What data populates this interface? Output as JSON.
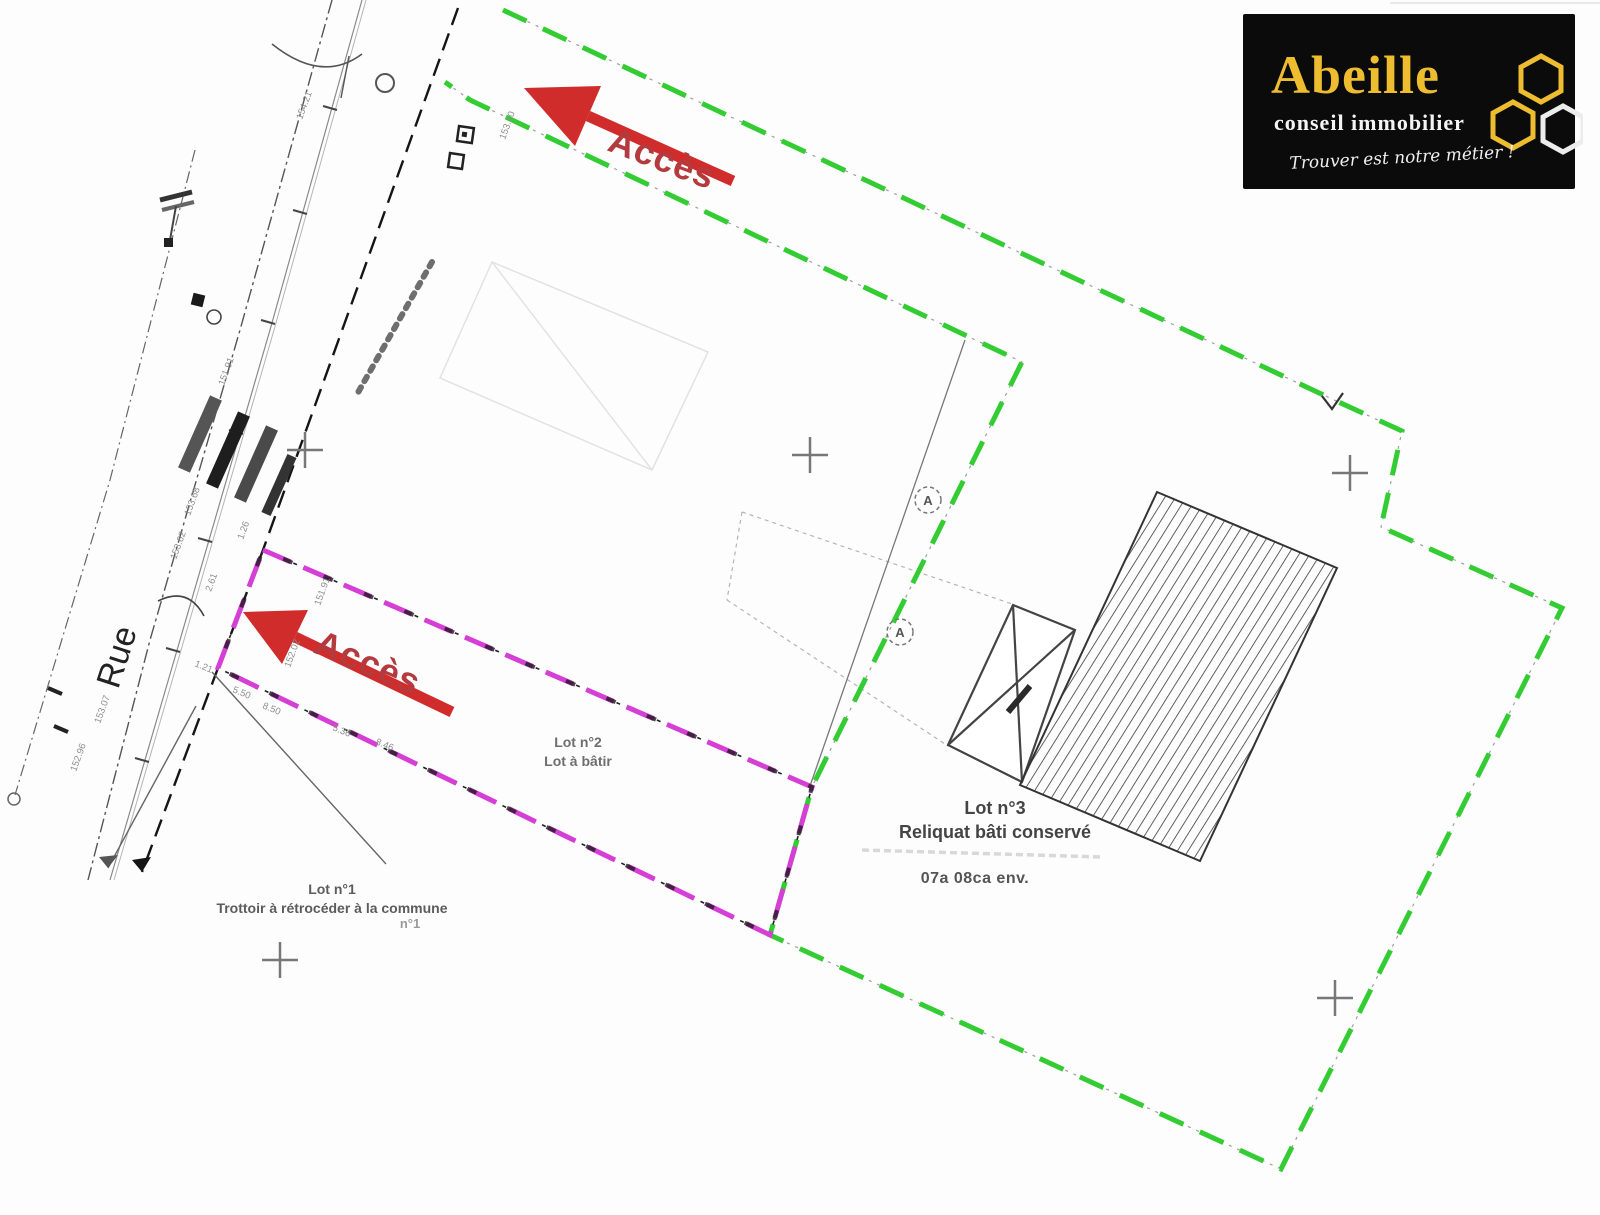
{
  "logo": {
    "brand": "Abeille",
    "subtitle": "conseil immobilier",
    "tagline": "Trouver est notre métier !",
    "colors": {
      "background": "#0b0b0b",
      "brand_gold": "#eebd2f",
      "text_white": "#f4f4f4"
    }
  },
  "plan": {
    "street_label": "Rue",
    "access_label": "Accès",
    "marker_a": "A",
    "lots": {
      "lot1": {
        "name": "Lot n°1",
        "description": "Trottoir à rétrocéder à la commune",
        "note": "n°1"
      },
      "lot2": {
        "name": "Lot n°2",
        "description": "Lot à bâtir"
      },
      "lot3": {
        "name": "Lot n°3",
        "description": "Reliquat bâti conservé",
        "area": "07a 08ca env."
      }
    },
    "colors": {
      "boundary_green": "#33cc33",
      "lot2_magenta": "#d63fd6",
      "access_red": "#d02c2c",
      "hatch_grey": "#3a3a3a"
    },
    "measurements": [
      {
        "text": "153.62",
        "x": 176,
        "y": 560,
        "rot": -70
      },
      {
        "text": "153.68",
        "x": 190,
        "y": 516,
        "rot": -70
      },
      {
        "text": "151.91",
        "x": 224,
        "y": 386,
        "rot": -70
      },
      {
        "text": "154.21",
        "x": 302,
        "y": 120,
        "rot": -70
      },
      {
        "text": "153.10",
        "x": 505,
        "y": 140,
        "rot": -70
      },
      {
        "text": "1.26",
        "x": 243,
        "y": 540,
        "rot": -70
      },
      {
        "text": "2.61",
        "x": 211,
        "y": 592,
        "rot": -70
      },
      {
        "text": "1.21",
        "x": 194,
        "y": 666,
        "rot": 22
      },
      {
        "text": "5.50",
        "x": 232,
        "y": 692,
        "rot": 22
      },
      {
        "text": "8.50",
        "x": 262,
        "y": 708,
        "rot": 22
      },
      {
        "text": "5.36",
        "x": 332,
        "y": 730,
        "rot": 22
      },
      {
        "text": "8.46",
        "x": 375,
        "y": 744,
        "rot": 22
      },
      {
        "text": "151.91",
        "x": 320,
        "y": 606,
        "rot": -70
      },
      {
        "text": "152.02",
        "x": 290,
        "y": 668,
        "rot": -70
      },
      {
        "text": "153.07",
        "x": 100,
        "y": 724,
        "rot": -70
      },
      {
        "text": "152.96",
        "x": 76,
        "y": 772,
        "rot": -70
      }
    ]
  }
}
